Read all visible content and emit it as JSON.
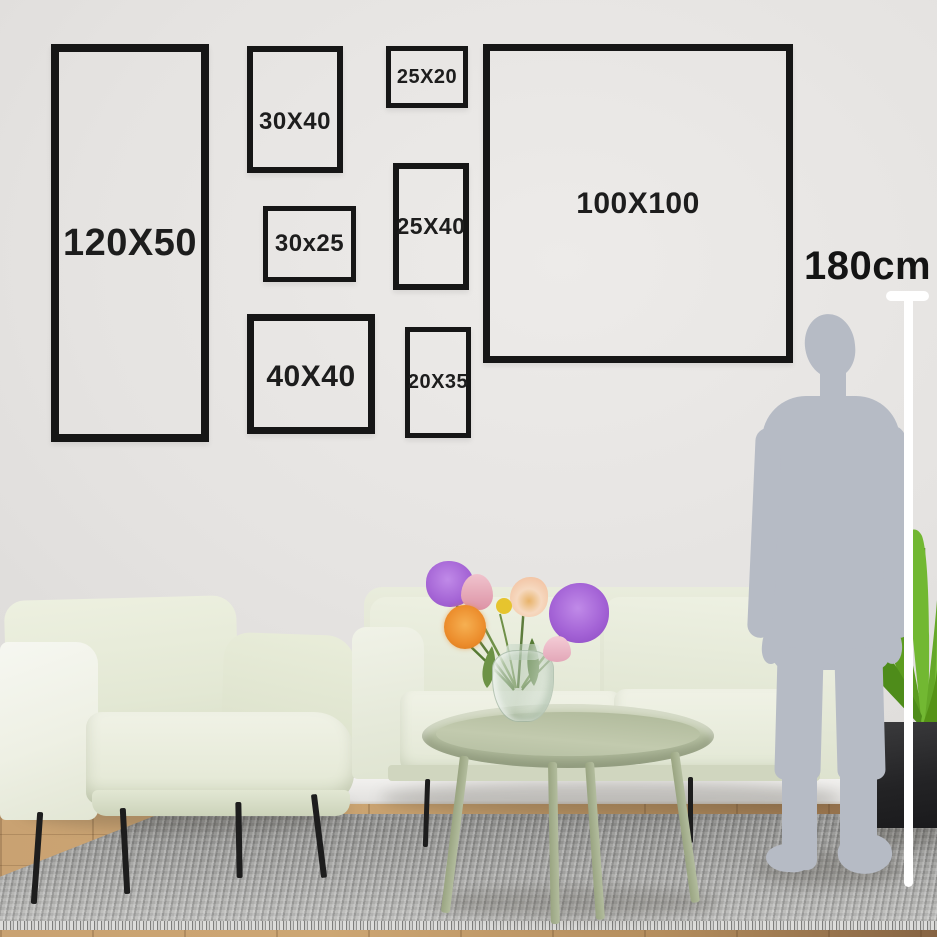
{
  "size_guide": {
    "frames": [
      {
        "id": "120x50",
        "label": "120X50",
        "height_cm": 120,
        "width_cm": 50
      },
      {
        "id": "30x40",
        "label": "30X40",
        "height_cm": 40,
        "width_cm": 30
      },
      {
        "id": "25x20",
        "label": "25X20",
        "height_cm": 20,
        "width_cm": 25
      },
      {
        "id": "30x25",
        "label": "30x25",
        "height_cm": 25,
        "width_cm": 30
      },
      {
        "id": "25x40",
        "label": "25X40",
        "height_cm": 40,
        "width_cm": 25
      },
      {
        "id": "40x40",
        "label": "40X40",
        "height_cm": 40,
        "width_cm": 40
      },
      {
        "id": "20x35",
        "label": "20X35",
        "height_cm": 35,
        "width_cm": 20
      },
      {
        "id": "100x100",
        "label": "100X100",
        "height_cm": 100,
        "width_cm": 100
      }
    ],
    "reference_height": {
      "label": "180cm",
      "value_cm": 180
    }
  },
  "colors": {
    "wall": "#e5e3e1",
    "frame_border": "#161616",
    "label_text": "#1d1d1d",
    "sofa_sage": "#e7ebdb",
    "table_sage": "#b4bea0",
    "rug_gray": "#a5a5a3",
    "floor_wood": "#c19a6b",
    "silhouette_gray": "#b6bbc5",
    "measure_line": "#ffffff",
    "plant_green": "#6fb52f",
    "flower_purple": "#a666d6",
    "flower_orange": "#ec8d2c",
    "flower_pink": "#e3a7b8",
    "flower_peach": "#f3c7a8",
    "flower_yellow": "#e6c42e"
  }
}
